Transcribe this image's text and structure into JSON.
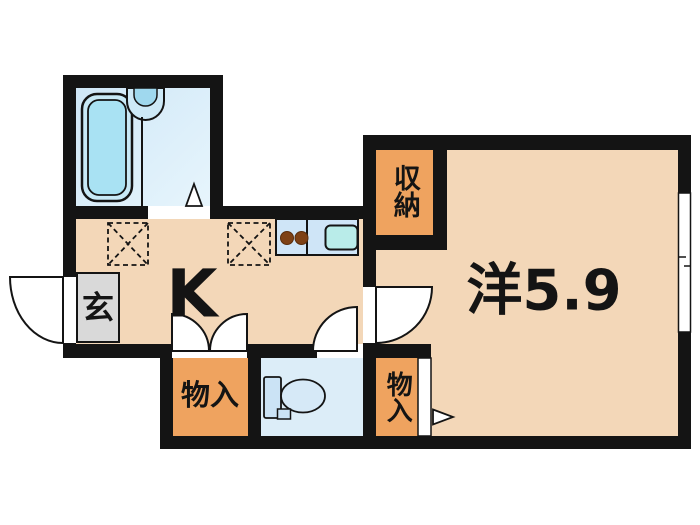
{
  "plan": {
    "labels": {
      "kitchen": "K",
      "western_room": "洋5.9",
      "entrance": "玄",
      "closet": "収納",
      "storage_left": "物入",
      "storage_right": "物入"
    },
    "colors": {
      "wall": "#141414",
      "floor_beige": "#f3d7b8",
      "closet_orange": "#efa35f",
      "bathroom_blue": "#d6ebf8",
      "genkan_gray": "#d9d9d9",
      "counter_blue": "#cfe5f7",
      "sink_teal": "#b9ece9",
      "burner_brown": "#7e4115",
      "toilet_floor_blue": "#dcedf8",
      "tub_blue": "#a9e2f3"
    }
  }
}
